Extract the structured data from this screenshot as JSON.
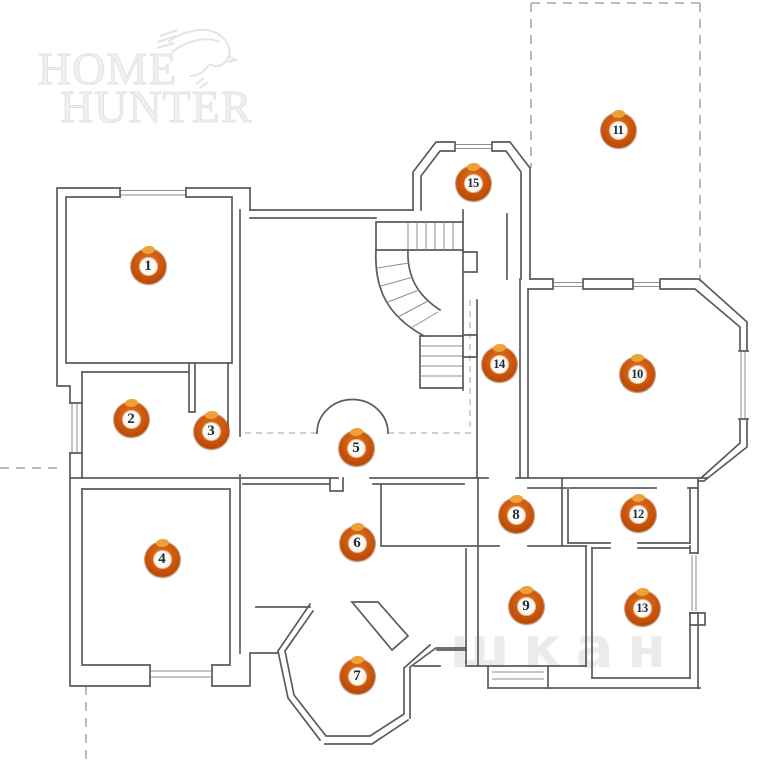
{
  "logo": {
    "line1": "HOME",
    "line2": "HUNTER"
  },
  "watermark_text": "шкан",
  "colors": {
    "wall": "#5b5b5b",
    "dash": "#a3a3a3",
    "marker_ring": "#c9530b",
    "marker_ring_hi": "#e0751c",
    "marker_ring_lo": "#a84200",
    "marker_blob": "#eda239",
    "marker_face": "#fdf9f2",
    "marker_number": "#1c2b3c",
    "watermark": "#d8d8d8"
  },
  "markers": [
    {
      "n": "1",
      "x": 148,
      "y": 266
    },
    {
      "n": "2",
      "x": 131,
      "y": 419
    },
    {
      "n": "3",
      "x": 211,
      "y": 431
    },
    {
      "n": "4",
      "x": 162,
      "y": 559
    },
    {
      "n": "5",
      "x": 356,
      "y": 448
    },
    {
      "n": "6",
      "x": 357,
      "y": 543
    },
    {
      "n": "7",
      "x": 357,
      "y": 676
    },
    {
      "n": "8",
      "x": 516,
      "y": 515
    },
    {
      "n": "9",
      "x": 526,
      "y": 606
    },
    {
      "n": "10",
      "x": 637,
      "y": 374
    },
    {
      "n": "11",
      "x": 618,
      "y": 130
    },
    {
      "n": "12",
      "x": 638,
      "y": 514
    },
    {
      "n": "13",
      "x": 642,
      "y": 608
    },
    {
      "n": "14",
      "x": 499,
      "y": 364
    },
    {
      "n": "15",
      "x": 473,
      "y": 183
    }
  ]
}
